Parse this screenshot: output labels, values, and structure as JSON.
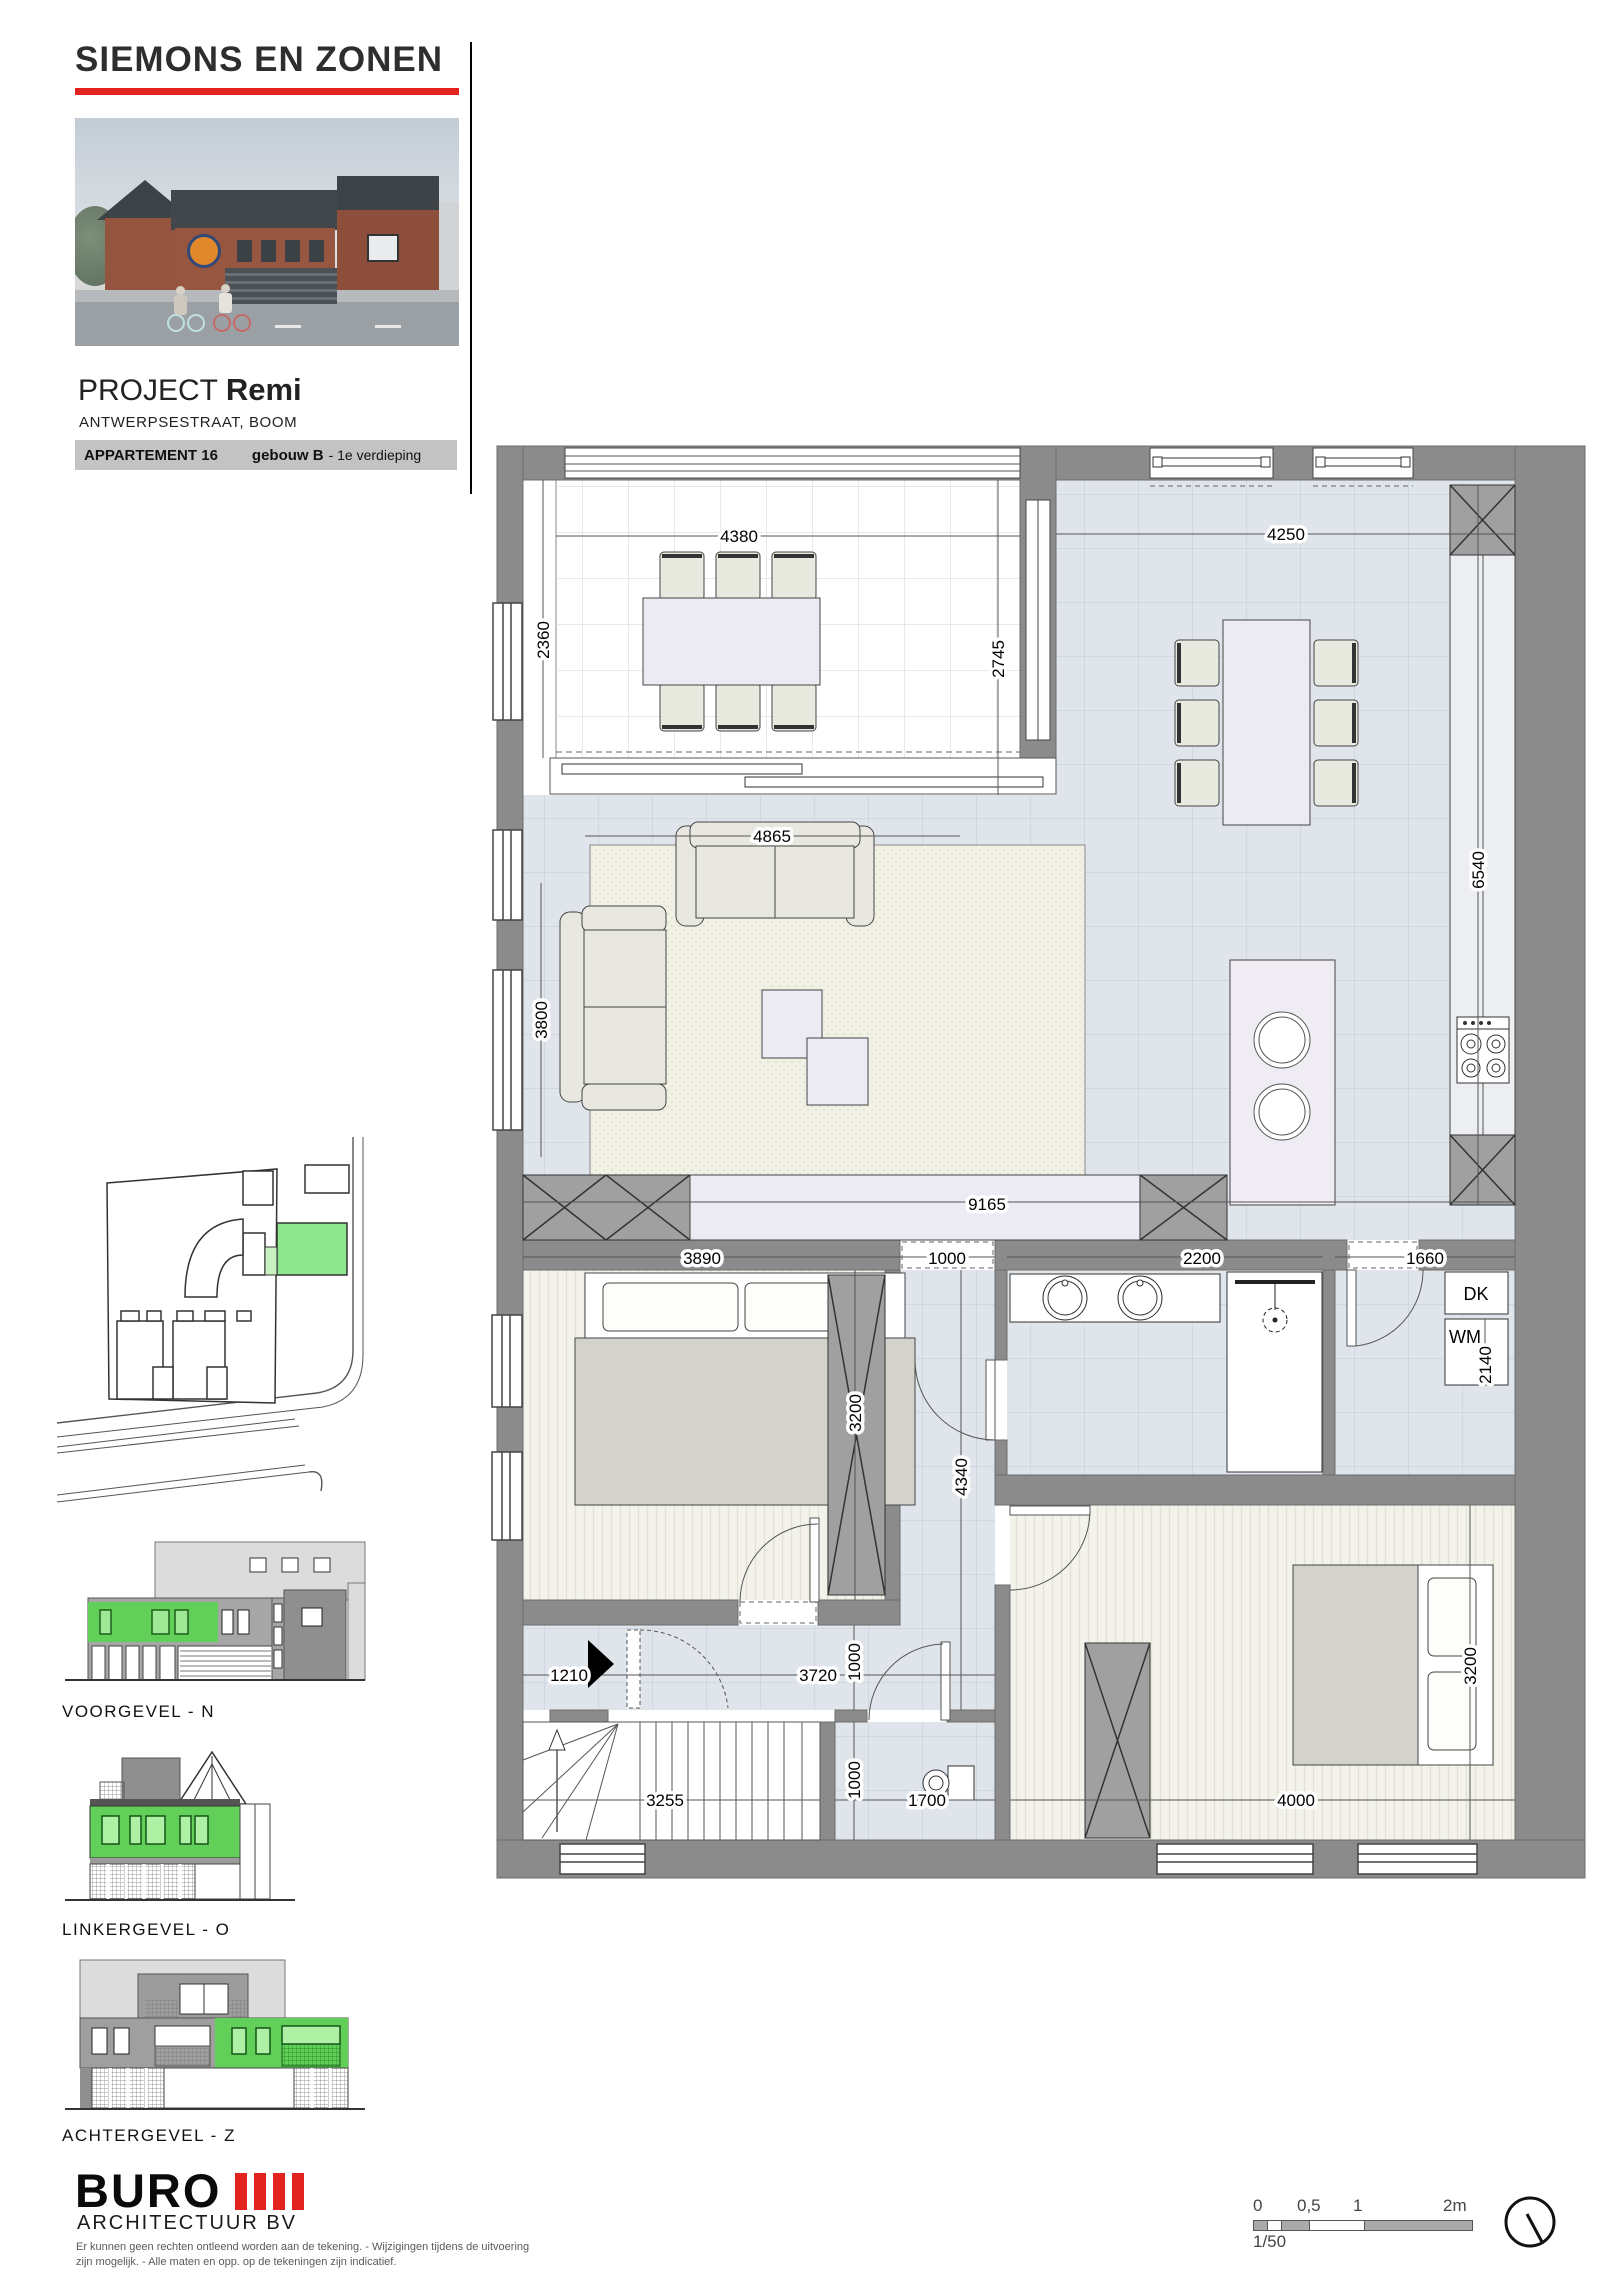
{
  "header": {
    "company": "SIEMONS EN ZONEN",
    "project_label": "PROJECT",
    "project_name": "Remi",
    "address": "ANTWERPSESTRAAT, BOOM",
    "apartment": "APPARTEMENT 16",
    "building": "gebouw B",
    "floor_suffix": "- 1e verdieping"
  },
  "plan": {
    "dims": {
      "terras_breedte": "4380",
      "terras_diepte": "2360",
      "terras_rechts": "2745",
      "eethoek_breedte": "4250",
      "keuken_diepte": "6540",
      "zithoek_breedte": "4865",
      "zithoek_diepte": "3800",
      "leefruimte_breedte": "9165",
      "slaapkamer1_breedte": "3890",
      "hal_breedte": "1000",
      "slaapkamer1_diepte": "3200",
      "hal_diepte": "4340",
      "badkamer_breedte": "2200",
      "berging_breedte": "1660",
      "berging_diepte": "2140",
      "inkom_breedte": "1210",
      "gang_breedte": "3720",
      "gang_diepte": "1000",
      "trap_breedte": "3255",
      "wc_breedte": "1000",
      "wc_diepte": "1700",
      "slaapkamer2_breedte": "4000",
      "slaapkamer2_diepte": "3200"
    },
    "labels": {
      "dryer": "DK",
      "washer": "WM"
    }
  },
  "sidebar": {
    "elevations": [
      {
        "label": "VOORGEVEL - N"
      },
      {
        "label": "LINKERGEVEL - O"
      },
      {
        "label": "ACHTERGEVEL - Z"
      }
    ]
  },
  "footer": {
    "firm": "BURO",
    "firm_sub": "ARCHITECTUUR BV",
    "disclaimer1": "Er kunnen geen rechten ontleend worden aan de tekening. - Wijzigingen tijdens de uitvoering",
    "disclaimer2": "zijn mogelijk. - Alle maten en opp. op de tekeningen zijn indicatief.",
    "scalebar": {
      "t0": "0",
      "t05": "0,5",
      "t1": "1",
      "t2": "2m",
      "ratio": "1/50"
    }
  },
  "colors": {
    "accent_red": "#e2231f",
    "highlight_green": "#62cf58"
  }
}
